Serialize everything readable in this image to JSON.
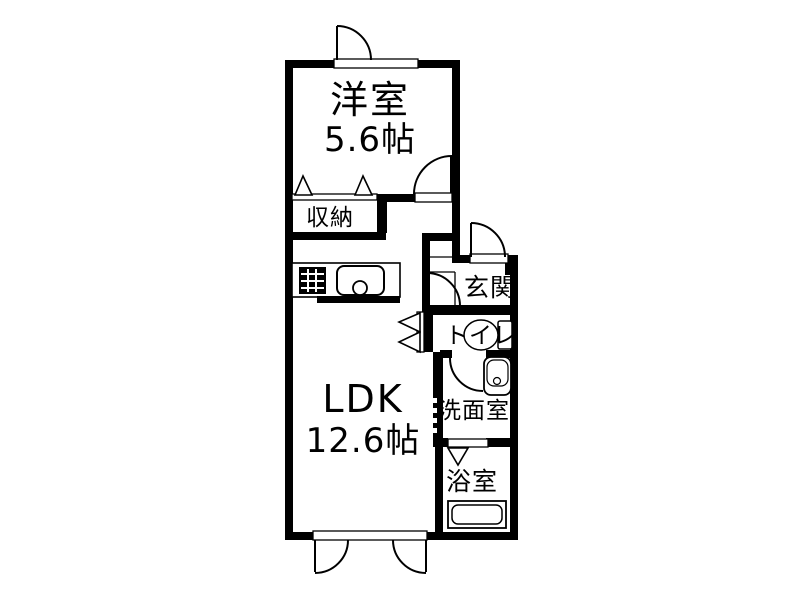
{
  "plan": {
    "title": "apartment-floorplan",
    "colors": {
      "wall": "#000000",
      "floor": "#ffffff",
      "line": "#000000"
    },
    "rooms": {
      "western_room": {
        "label": "洋室",
        "size": "5.6帖"
      },
      "ldk": {
        "label": "LDK",
        "size": "12.6帖"
      },
      "closet": {
        "label": "収納"
      },
      "entrance": {
        "label": "玄関"
      },
      "toilet": {
        "label": "トイレ"
      },
      "washroom": {
        "label": "洗面室"
      },
      "bathroom": {
        "label": "浴室"
      }
    },
    "fixtures": {
      "stove": "stove-icon",
      "sink": "kitchen-sink-icon",
      "toilet": "toilet-icon",
      "washbasin": "washbasin-icon",
      "bathtub": "bathtub-icon"
    }
  }
}
